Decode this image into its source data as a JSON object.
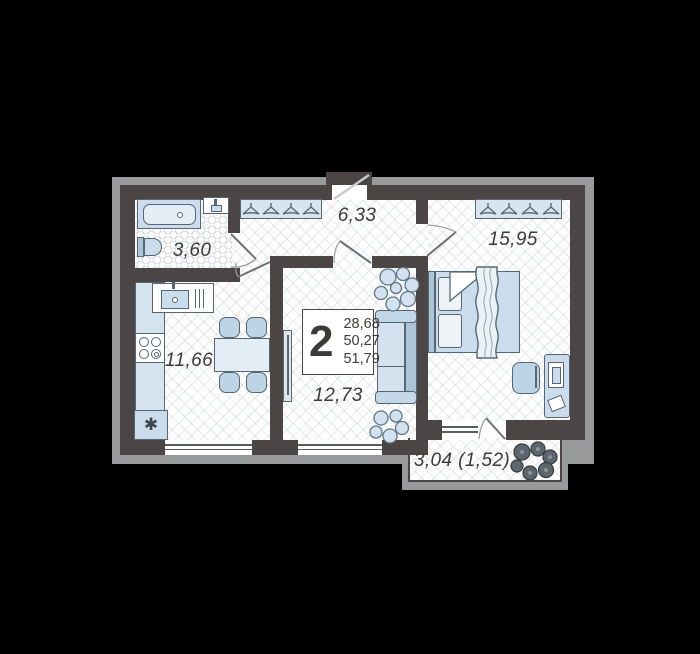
{
  "badge": {
    "rooms_count": "2",
    "areas": [
      "28,68",
      "50,27",
      "51,79"
    ]
  },
  "rooms": {
    "bathroom": {
      "area": "3,60"
    },
    "hallway": {
      "area": "6,33"
    },
    "bedroom": {
      "area": "15,95"
    },
    "kitchen": {
      "area": "11,66"
    },
    "living_room": {
      "area": "12,73"
    },
    "balcony": {
      "area": "3,04 (1,52)"
    }
  },
  "symbols": {
    "washing_machine": "✱"
  },
  "icons": [
    "hanger-icon",
    "plant-icon",
    "bathtub-icon",
    "toilet-icon",
    "sink-icon",
    "stove-icon",
    "bed-icon",
    "sofa-icon",
    "tv-icon",
    "desk-icon",
    "laptop-icon",
    "washing-machine-icon",
    "door-swing-icon",
    "window-icon"
  ],
  "colors": {
    "background": "#000000",
    "wall": "#4b4645",
    "floor": "#fdfdfd",
    "plan_shadow": "#97999a",
    "furniture_fill": "#cbdded",
    "furniture_outline": "#566672",
    "label_text": "#3d3b39"
  }
}
